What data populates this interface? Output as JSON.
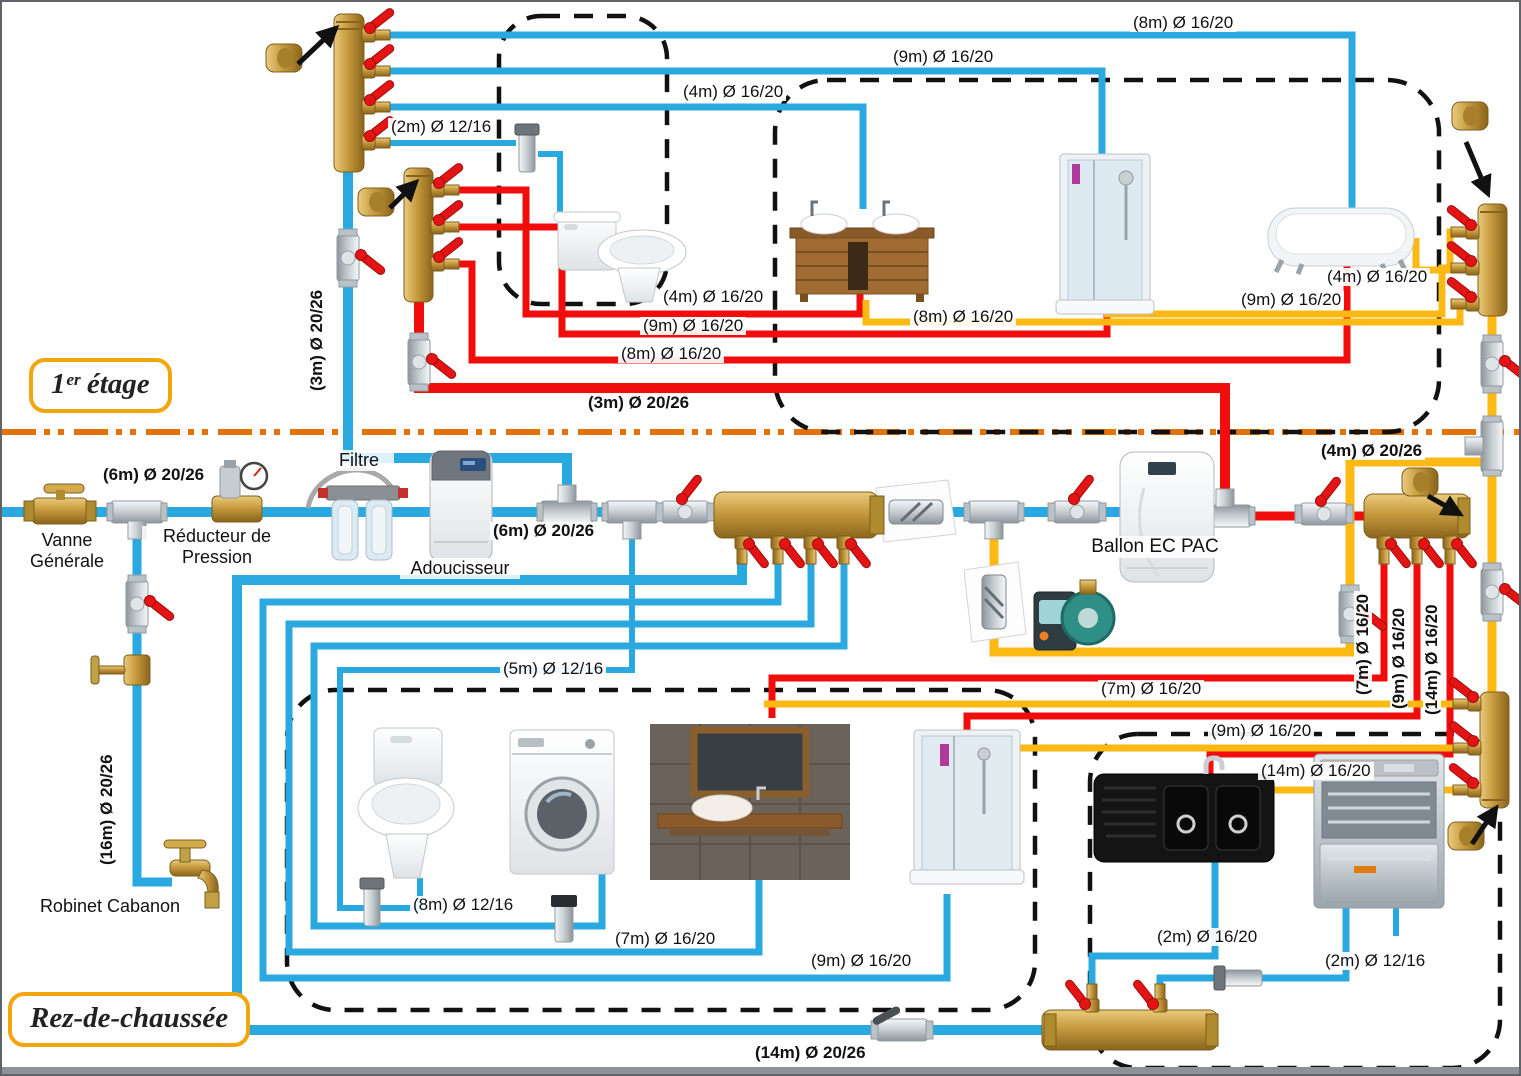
{
  "colors": {
    "cold": "#2AA9E1",
    "hot": "#F20D0D",
    "ret": "#FCB813",
    "floor_line": "#E0740B",
    "box_border": "#F2A50C"
  },
  "floors": {
    "first": "1ᵉʳ étage",
    "ground": "Rez-de-chaussée"
  },
  "equipment_labels": {
    "vanne_generale": "Vanne\nGénérale",
    "reducteur": "Réducteur de\nPression",
    "filtre": "Filtre",
    "adoucisseur": "Adoucisseur",
    "ballon": "Ballon EC PAC",
    "robinet_cabanon": "Robinet Cabanon"
  },
  "pipe_labels": {
    "ff_cold_8m": "(8m) Ø 16/20",
    "ff_cold_9m": "(9m) Ø 16/20",
    "ff_cold_4m": "(4m) Ø 16/20",
    "ff_cold_2m": "(2m) Ø 12/16",
    "ff_riser_cold_3m": "(3m) Ø 20/26",
    "ff_hot_4m": "(4m) Ø 16/20",
    "ff_hot_9m": "(9m) Ø 16/20",
    "ff_hot_8m": "(8m) Ø 16/20",
    "ff_hot_main_3m": "(3m) Ø 20/26",
    "ff_ret_8m": "(8m) Ø 16/20",
    "ff_ret_9m": "(9m) Ø 16/20",
    "ff_ret_4m": "(4m) Ø 16/20",
    "main_6m_left": "(6m) Ø 20/26",
    "main_6m_mid": "(6m) Ø 20/26",
    "ret_main_4m": "(4m) Ø 20/26",
    "gf_hot_7m_v": "(7m) Ø 16/20",
    "gf_hot_9m_v": "(9m) Ø 16/20",
    "gf_hot_14m_v": "(14m) Ø 16/20",
    "gf_cold_5m": "(5m) Ø 12/16",
    "gf_ret_7m": "(7m) Ø 16/20",
    "gf_ret_9m": "(9m) Ø 16/20",
    "gf_ret_14m": "(14m) Ø 16/20",
    "cabanon_16m": "(16m) Ø 20/26",
    "gf_cold_8m": "(8m) Ø 12/16",
    "gf_cold_7m": "(7m) Ø 16/20",
    "gf_cold_9m": "(9m) Ø 16/20",
    "gf_cold_sink_2m": "(2m) Ø 16/20",
    "gf_cold_dw_2m": "(2m) Ø 12/16",
    "gf_cold_main_14m": "(14m) Ø 20/26"
  }
}
